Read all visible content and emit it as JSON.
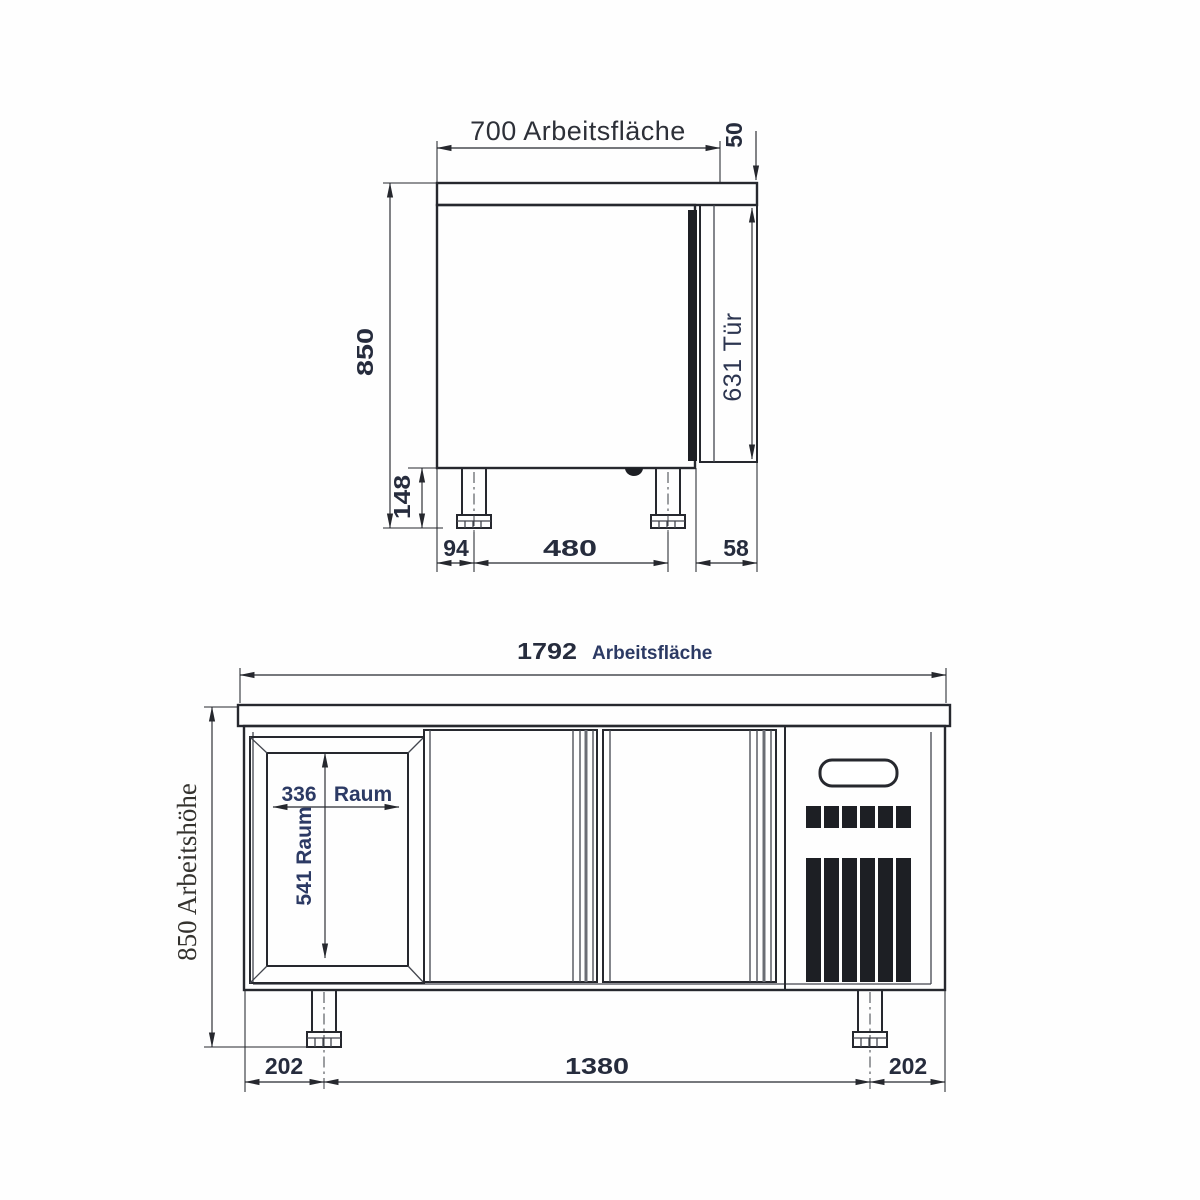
{
  "drawing": {
    "description": "Technical dimension drawing of a refrigerated worktable, side view and front view",
    "ink_color": "#26282e",
    "label_color": "#2c3a64",
    "side_view": {
      "labels": {
        "worktop_width": "700 Arbeitsfläche",
        "worktop_thickness": "50",
        "overall_height": "850",
        "door_height": "631 Tür",
        "foot_height": "148",
        "foot_offset_back": "94",
        "foot_spacing": "480",
        "door_offset_front": "58"
      }
    },
    "front_view": {
      "labels": {
        "worktop_width_value": "1792",
        "worktop_width_word": "Arbeitsfläche",
        "working_height": "850 Arbeitshöhe",
        "compartment_width_value": "336",
        "compartment_width_word": "Raum",
        "compartment_height": "541 Raum",
        "margin_left": "202",
        "foot_spacing": "1380",
        "margin_right": "202"
      }
    }
  }
}
